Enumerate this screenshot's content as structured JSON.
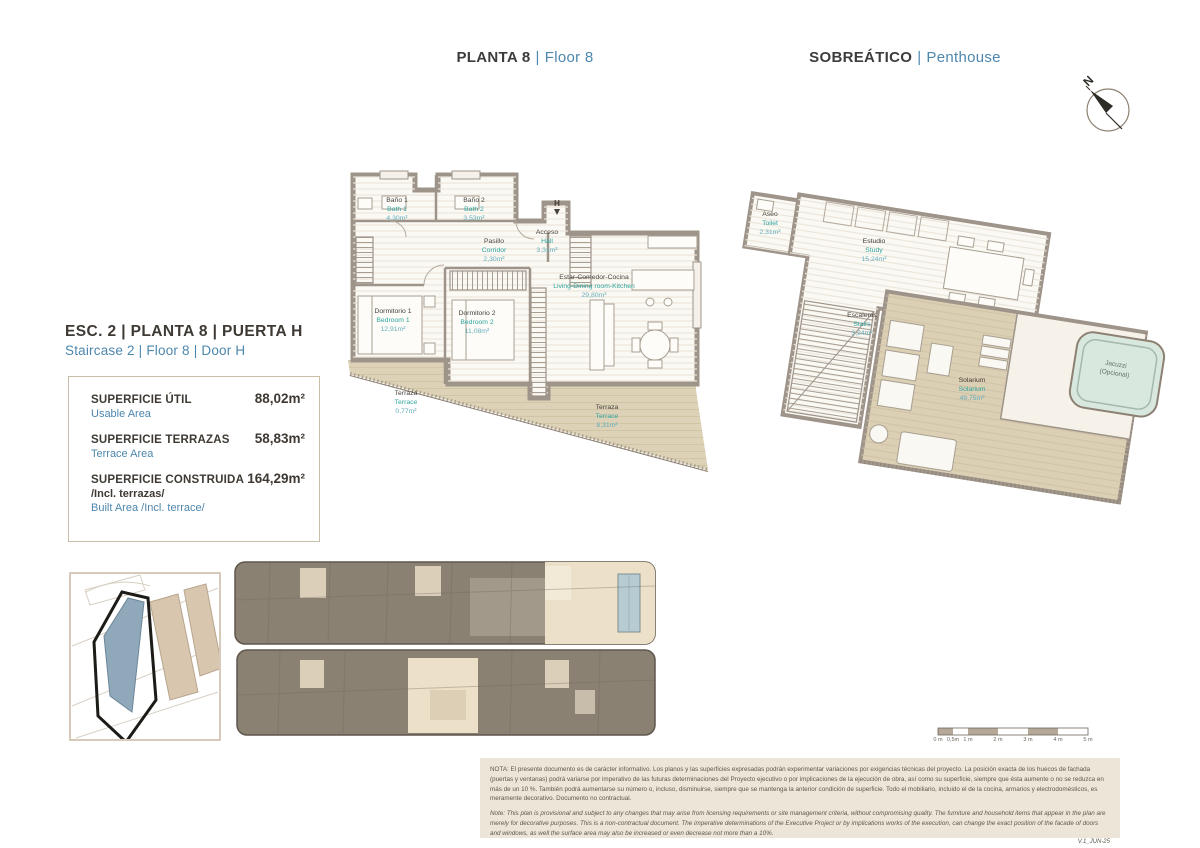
{
  "headers": {
    "left_es": "PLANTA 8",
    "left_en": "Floor 8",
    "right_es": "SOBREÁTICO",
    "right_en": "Penthouse",
    "sep": "|"
  },
  "compass_label": "N",
  "unit_info": {
    "title_es": "ESC. 2 | PLANTA 8 | PUERTA H",
    "title_en": "Staircase 2 | Floor 8 | Door H",
    "areas": [
      {
        "label_es": "SUPERFICIE ÚTIL",
        "label_en": "Usable Area",
        "value": "88,02m²"
      },
      {
        "label_es": "SUPERFICIE TERRAZAS",
        "label_en": "Terrace Area",
        "value": "58,83m²"
      },
      {
        "label_es": "SUPERFICIE CONSTRUIDA",
        "label_es2": "/Incl. terrazas/",
        "label_en": "Built Area /Incl. terrace/",
        "value": "164,29m²"
      }
    ]
  },
  "floor8_plan": {
    "entrance_label": "H",
    "rooms": [
      {
        "name_es": "Baño 1",
        "name_en": "Bath 1",
        "area": "4,30m²"
      },
      {
        "name_es": "Baño 2",
        "name_en": "Bath 2",
        "area": "3,53m²"
      },
      {
        "name_es": "Pasillo",
        "name_en": "Corridor",
        "area": "2,30m²"
      },
      {
        "name_es": "Acceso",
        "name_en": "Hall",
        "area": "3,31m²"
      },
      {
        "name_es": "Estar-Comedor-Cocina",
        "name_en": "Living-Dining room-Kitchen",
        "area": "29,80m²"
      },
      {
        "name_es": "Dormitorio 1",
        "name_en": "Bedroom 1",
        "area": "12,91m²"
      },
      {
        "name_es": "Dormitorio 2",
        "name_en": "Bedroom 2",
        "area": "11,08m²"
      },
      {
        "name_es": "Terraza",
        "name_en": "Terrace",
        "area": "0,77m²"
      },
      {
        "name_es": "Terraza",
        "name_en": "Terrace",
        "area": "8,31m²"
      }
    ]
  },
  "penthouse_plan": {
    "rooms": [
      {
        "name_es": "Aseo",
        "name_en": "Toilet",
        "area": "2,31m²"
      },
      {
        "name_es": "Estudio",
        "name_en": "Study",
        "area": "15,24m²"
      },
      {
        "name_es": "Escaleras",
        "name_en": "Stairs",
        "area": "3,24m²"
      },
      {
        "name_es": "Solarium",
        "name_en": "Solarium",
        "area": "49,75m²"
      }
    ],
    "jacuzzi_line1": "Jacuzzi",
    "jacuzzi_line2": "(Opcional)"
  },
  "scale_bar": [
    "0 m",
    "0,5m",
    "1 m",
    "2 m",
    "3 m",
    "4 m",
    "5 m"
  ],
  "disclaimer": {
    "es": "NOTA: El presente documento es de carácter informativo. Los planos y las superficies expresadas podrán experimentar variaciones por exigencias técnicas del proyecto. La posición exacta de los huecos de fachada (puertas y ventanas) podrá variarse por imperativo de las futuras determinaciones del Proyecto ejecutivo o por implicaciones de la ejecución de obra, así como su superficie, siempre que ésta aumente o no se reduzca en más de un 10 %. También podrá aumentarse su número o, incluso, disminuirse, siempre que se mantenga la anterior condición de superficie. Todo el mobiliario, incluido el de la cocina, armarios y electrodomésticos, es meramente decorativo. Documento no contractual.",
    "en": "Note: This plan is provisional and subject to any changes that may arise from licensing requirements or site management criteria, without compromising quality. The furniture and household items that appear in the plan are merely for decorative purposes. This is a non-contractual document. The imperative determinations of the Executive Project or by implications works of the execution, can change the exact position of the facade of doors and windows, as well the surface area may also be increased or even decrease not more than a 10%.",
    "version": "V.1_JUN-25"
  },
  "colors": {
    "accent_blue": "#4e87ad",
    "teal": "#2fa49e",
    "wall": "#9e948a",
    "terrace": "#ddd2b7",
    "highlight": "#ece0c8"
  }
}
